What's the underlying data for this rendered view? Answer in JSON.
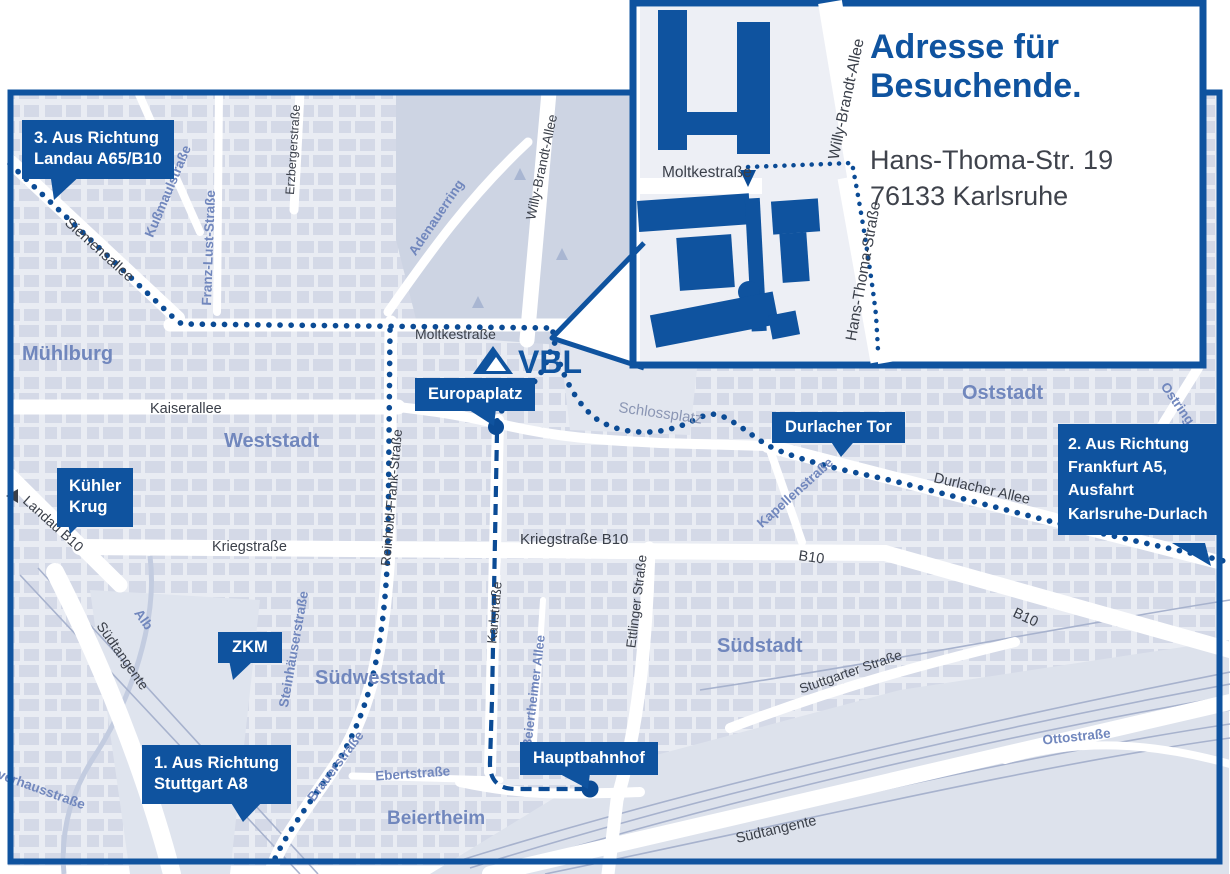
{
  "colors": {
    "primary": "#0f539f",
    "route": "#0b4b95",
    "street_text": "#3a3f49",
    "district_text": "#7187bd",
    "map_bg": "#e9ecf3",
    "block_fill": "#d4d9e7",
    "park_fill": "#cdd4e3",
    "light_zone": "#dde2ec",
    "rail_line": "#a7b2cd",
    "water": "#c3cce0"
  },
  "logo": {
    "text": "VBL"
  },
  "inset": {
    "title_line1": "Adresse für",
    "title_line2": "Besuchende.",
    "address_line1": "Hans-Thoma-Str. 19",
    "address_line2": "76133 Karlsruhe",
    "streets": {
      "moltkestrasse": "Moltkestraße",
      "willy_brandt_allee": "Willy-Brandt-Allee",
      "hans_thoma_strasse": "Hans-Thoma-Straße"
    }
  },
  "callouts": {
    "route3": {
      "lines": [
        "3. Aus Richtung",
        "Landau A65/B10"
      ]
    },
    "kuehler_krug": {
      "lines": [
        "Kühler",
        "Krug"
      ]
    },
    "zkm": {
      "lines": [
        "ZKM"
      ]
    },
    "route1": {
      "lines": [
        "1. Aus Richtung",
        "Stuttgart A8"
      ]
    },
    "europaplatz": {
      "lines": [
        "Europaplatz"
      ]
    },
    "hauptbahnhof": {
      "lines": [
        "Hauptbahnhof"
      ]
    },
    "durlacher_tor": {
      "lines": [
        "Durlacher Tor"
      ]
    },
    "route2": {
      "lines": [
        "2. Aus Richtung",
        "Frankfurt A5,",
        "Ausfahrt",
        "Karlsruhe-Durlach"
      ]
    }
  },
  "streets": {
    "moltkestrasse": "Moltkestraße",
    "kaiserallee": "Kaiserallee",
    "kriegstrasse": "Kriegstraße",
    "kriegstrasse_b10": "Kriegstraße B10",
    "durlacher_allee": "Durlacher Allee",
    "b10": "B10",
    "b10_southeast": "B10",
    "siemensallee": "Siemensallee",
    "landau_b10": "Landau B10",
    "suedtangente_west": "Südtangente",
    "suedtangente_ost": "Südtangente",
    "willy_brandt_allee": "Willy-Brandt-Allee",
    "reinhold_frank_strasse": "Reinhold-Frank-Straße",
    "karlstrasse": "Karlstraße",
    "ettlinger_strasse": "Ettlinger Straße",
    "stuttgarter_strasse": "Stuttgarter Straße",
    "erzbergerstrasse": "Erzbergerstraße"
  },
  "places": {
    "muehlburg": "Mühlburg",
    "weststadt": "Weststadt",
    "oststadt": "Oststadt",
    "suedstadt": "Südstadt",
    "suedweststadt": "Südweststadt",
    "beiertheim": "Beiertheim",
    "schlossplatz": "Schlossplatz",
    "adenauerring": "Adenauerring",
    "kussmaulstrasse": "Kußmaulstraße",
    "franz_lust_strasse": "Franz-Lust-Straße",
    "steinhaeuserstrasse": "Steinhäuserstraße",
    "kapellenstrasse": "Kapellenstraße",
    "ostring": "Ostring",
    "ottostrasse": "Ottostraße",
    "alb": "Alb",
    "pulverhausstrasse": "Pulverhausstraße",
    "brauerstrasse": "Brauerstraße",
    "ebertstrasse": "Ebertstraße",
    "beiertheimer_allee": "Beiertheimer Allee"
  }
}
